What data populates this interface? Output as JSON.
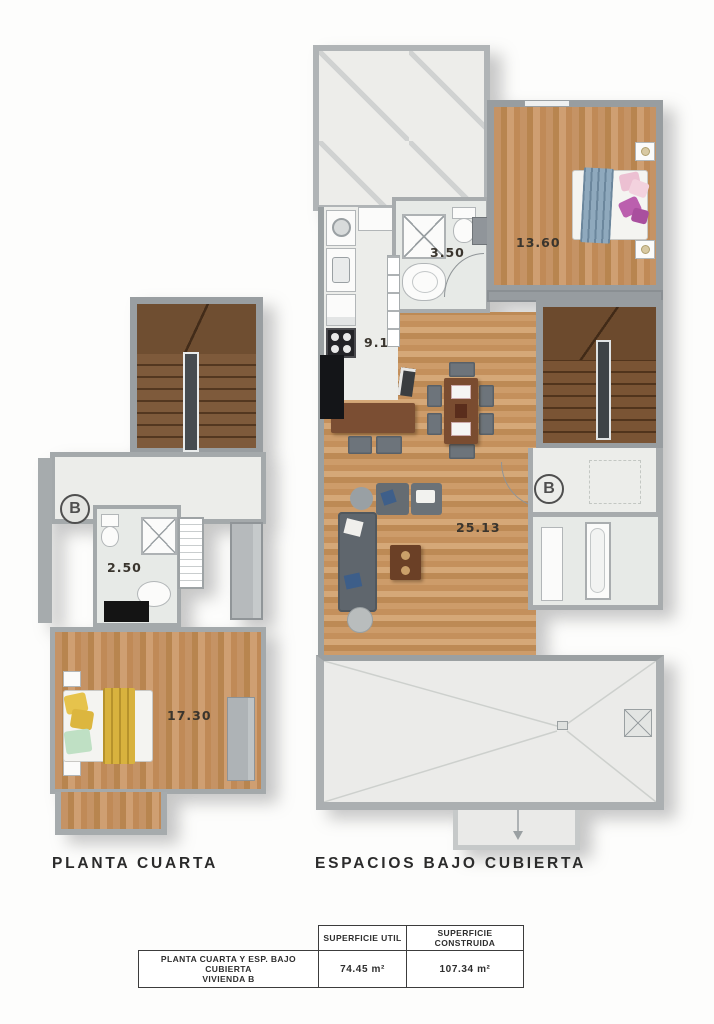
{
  "plans": {
    "planta_cuarta": {
      "title": "PLANTA CUARTA",
      "unit_badge": "B",
      "measurements": {
        "bathroom": "2.50",
        "bedroom": "17.30"
      }
    },
    "espacios_bajo_cubierta": {
      "title": "ESPACIOS BAJO CUBIERTA",
      "unit_badge": "B",
      "measurements": {
        "bathroom": "3.50",
        "bedroom": "13.60",
        "kitchen": "9.10",
        "living_room": "25.13"
      }
    }
  },
  "summary_table": {
    "headers": [
      "SUPERFICIE UTIL",
      "SUPERFICIE CONSTRUIDA"
    ],
    "row": {
      "label_line1": "PLANTA CUARTA Y ESP. BAJO CUBIERTA",
      "label_line2": "VIVIENDA B",
      "superficie_util": "74.45 m²",
      "superficie_construida": "107.34 m²"
    }
  },
  "palette": {
    "wall_gray": "#a4a9ab",
    "wood_floor": "#c59365",
    "stair_wood": "#7e5a3b",
    "blanket_yellow": "#d8b23e",
    "blanket_blue": "#8fa9bd",
    "pillow_pink": "#ecc0d2",
    "pillow_purple": "#bb5fae",
    "counter_black": "#141518"
  }
}
